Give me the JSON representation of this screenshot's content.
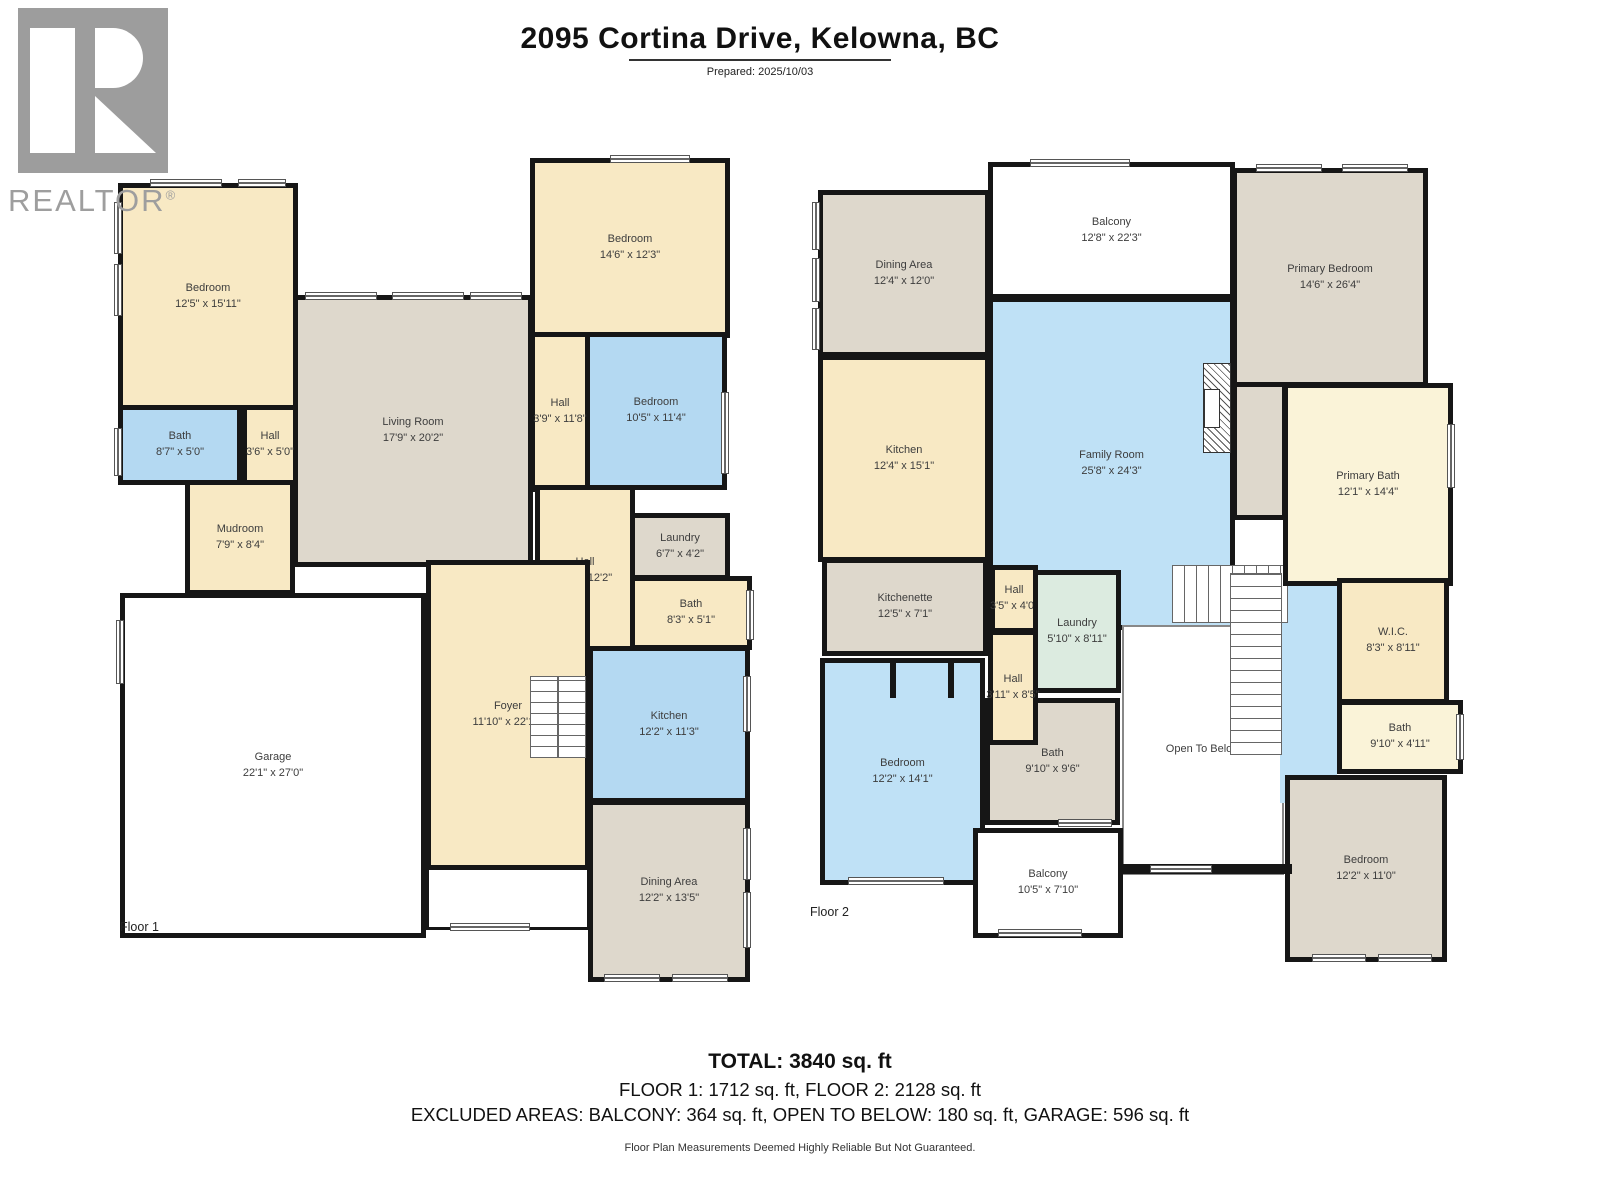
{
  "header": {
    "title": "2095 Cortina Drive, Kelowna, BC",
    "prepared": "Prepared: 2025/10/03"
  },
  "logo": {
    "brand": "REALTOR",
    "reg": "®"
  },
  "colors": {
    "wall": "#161616",
    "cream": "#f8e9c4",
    "blue": "#b4d9f2",
    "gray_beige": "#ded8cc",
    "pale_yellow": "#faf3d8",
    "mint": "#dcebe0",
    "logo_gray": "#9e9e9e"
  },
  "floor1": {
    "label": "Floor 1",
    "rooms": [
      {
        "name": "Bedroom",
        "dims": "12'5\" x 15'11\""
      },
      {
        "name": "Bath",
        "dims": "8'7\" x 5'0\""
      },
      {
        "name": "Hall",
        "dims": "3'6\" x 5'0\""
      },
      {
        "name": "Living Room",
        "dims": "17'9\" x 20'2\""
      },
      {
        "name": "Bedroom",
        "dims": "14'6\" x 12'3\""
      },
      {
        "name": "Hall",
        "dims": "3'9\" x 11'8\""
      },
      {
        "name": "Bedroom",
        "dims": "10'5\" x 11'4\""
      },
      {
        "name": "Hall",
        "dims": "7'7\" x 12'2\""
      },
      {
        "name": "Laundry",
        "dims": "6'7\" x 4'2\""
      },
      {
        "name": "Bath",
        "dims": "8'3\" x 5'1\""
      },
      {
        "name": "Kitchen",
        "dims": "12'2\" x 11'3\""
      },
      {
        "name": "Dining Area",
        "dims": "12'2\" x 13'5\""
      },
      {
        "name": "Foyer",
        "dims": "11'10\" x 22'11\""
      },
      {
        "name": "Mudroom",
        "dims": "7'9\" x 8'4\""
      },
      {
        "name": "Garage",
        "dims": "22'1\" x 27'0\""
      }
    ]
  },
  "floor2": {
    "label": "Floor 2",
    "rooms": [
      {
        "name": "Dining Area",
        "dims": "12'4\" x 12'0\""
      },
      {
        "name": "Kitchen",
        "dims": "12'4\" x 15'1\""
      },
      {
        "name": "Balcony",
        "dims": "12'8\" x 22'3\""
      },
      {
        "name": "Family Room",
        "dims": "25'8\" x 24'3\""
      },
      {
        "name": "Primary Bedroom",
        "dims": "14'6\" x 26'4\""
      },
      {
        "name": "Primary Bath",
        "dims": "12'1\" x 14'4\""
      },
      {
        "name": "Kitchenette",
        "dims": "12'5\" x 7'1\""
      },
      {
        "name": "Hall",
        "dims": "3'5\" x 4'0\""
      },
      {
        "name": "Laundry",
        "dims": "5'10\" x 8'11\""
      },
      {
        "name": "Hall",
        "dims": "3'11\" x 8'5\""
      },
      {
        "name": "Bath",
        "dims": "9'10\" x 9'6\""
      },
      {
        "name": "Bedroom",
        "dims": "12'2\" x 14'1\""
      },
      {
        "name": "Balcony",
        "dims": "10'5\" x 7'10\""
      },
      {
        "name": "Open To Below",
        "dims": ""
      },
      {
        "name": "W.I.C.",
        "dims": "8'3\" x 8'11\""
      },
      {
        "name": "Bath",
        "dims": "9'10\" x 4'11\""
      },
      {
        "name": "Bedroom",
        "dims": "12'2\" x 11'0\""
      }
    ]
  },
  "footer": {
    "total": "TOTAL: 3840 sq. ft",
    "floors": "FLOOR 1: 1712 sq. ft, FLOOR 2: 2128 sq. ft",
    "excluded": "EXCLUDED AREAS: BALCONY: 364 sq. ft, OPEN TO BELOW: 180 sq. ft, GARAGE: 596 sq. ft",
    "disclaimer": "Floor Plan Measurements Deemed Highly Reliable But Not Guaranteed."
  }
}
